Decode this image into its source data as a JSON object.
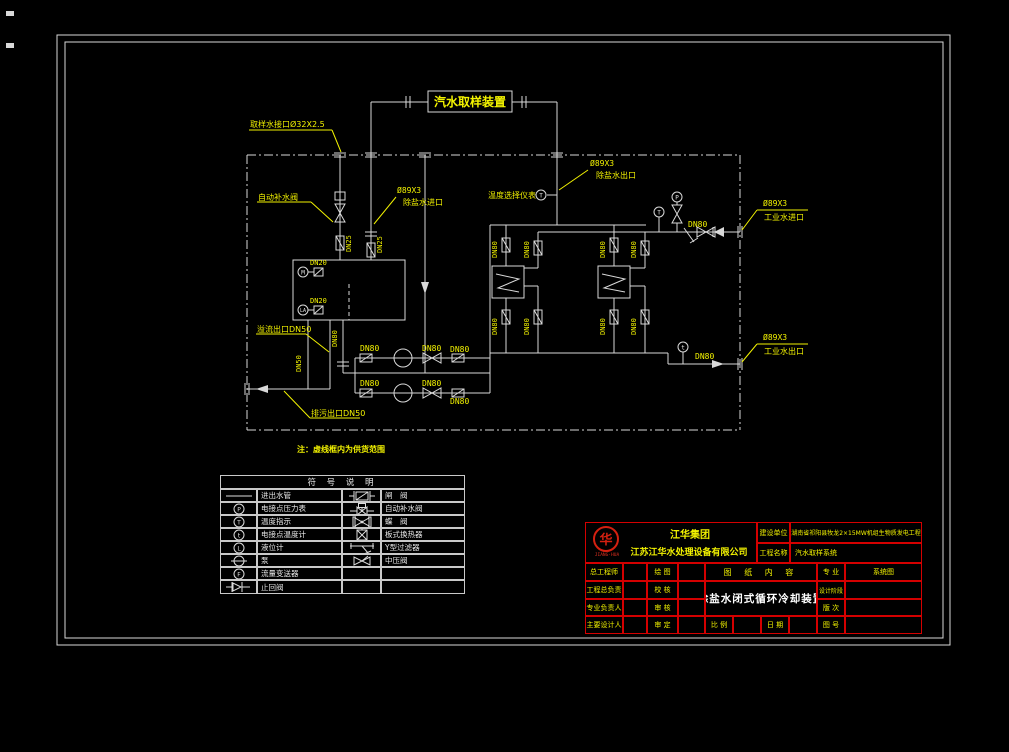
{
  "drawing": {
    "sampling_device": "汽水取样装置",
    "note": "注：虚线框内为供货范围",
    "labels": {
      "sample_inlet": "取样水接口Ø32X2.5",
      "auto_makeup_valve": "自动补水阀",
      "demin_size": "Ø89X3",
      "demin_inlet": "除盐水进口",
      "demin_outlet": "除盐水出口",
      "temp_selector": "温度选择仪表",
      "industrial_size": "Ø89X3",
      "industrial_inlet": "工业水进口",
      "industrial_outlet": "工业水出口",
      "overflow_outlet": "溢流出口DN50",
      "blowdown_outlet": "排污出口DN50"
    },
    "sizes": {
      "dn80": "DN80",
      "dn50": "DN50",
      "dn25": "DN25",
      "dn20": "DN20"
    },
    "instruments": {
      "p": "P",
      "t_upper": "T",
      "t_lower": "t",
      "l": "L",
      "m": "M",
      "la": "LA",
      "f": "F"
    }
  },
  "legend": {
    "title": "符  号  说  明",
    "rows": [
      {
        "left": "进出水管",
        "right": "闸　阀"
      },
      {
        "left": "电接点压力表",
        "right": "自动补水阀"
      },
      {
        "left": "温度指示",
        "right": "蝶　阀"
      },
      {
        "left": "电接点温度计",
        "right": "板式换热器"
      },
      {
        "left": "液位计",
        "right": "Y型过滤器"
      },
      {
        "left": "泵",
        "right": "中压阀"
      },
      {
        "left": "流量变送器",
        "right": ""
      },
      {
        "left": "止回阀",
        "right": ""
      }
    ]
  },
  "title_block": {
    "company_group": "江华集团",
    "company": "江苏江华水处理设备有限公司",
    "logo_text": "JIANG·HUA",
    "logo_glyph": "华",
    "construction_unit_label": "建设单位",
    "construction_unit": "湖南省祁阳县牧龙2×15MW机组生物质发电工程",
    "project_name_label": "工程名称",
    "project_name": "汽水取样系统",
    "chief_engineer": "总工程师",
    "project_leader": "工程总负责",
    "discipline_leader": "专业负责人",
    "main_designer": "主要设计人",
    "drawn": "绘  图",
    "checked": "校  核",
    "reviewed": "审  核",
    "approved": "审  定",
    "content_label": "图 纸 内 容",
    "drawing_title": "除盐水闭式循环冷却装置",
    "discipline_label": "专  业",
    "discipline": "系统图",
    "design_stage_label": "设计阶段",
    "version_label": "版  次",
    "scale_label": "比  例",
    "date_label": "日  期",
    "drawing_no_label": "图  号"
  },
  "colors": {
    "line": "#d9d9d9",
    "label": "#f2f200",
    "title_block_line": "#d40000",
    "logo": "#d42010"
  }
}
